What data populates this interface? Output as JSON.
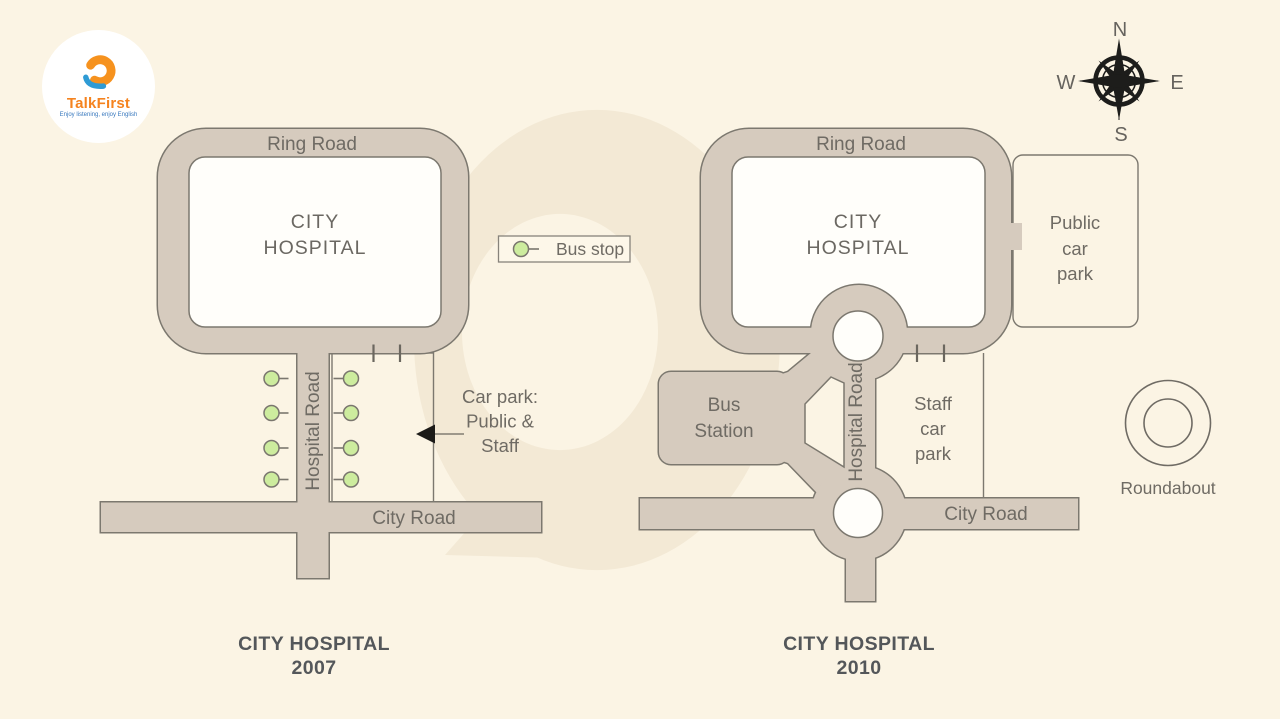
{
  "logo": {
    "brand": "TalkFirst",
    "tagline": "Enjoy listening, enjoy English"
  },
  "compass": {
    "north": "N",
    "east": "E",
    "south": "S",
    "west": "W"
  },
  "legend": {
    "bus_stop_label": "Bus stop",
    "roundabout_label": "Roundabout"
  },
  "map_2007": {
    "title": [
      "CITY HOSPITAL",
      "2007"
    ],
    "ring_road_label": "Ring Road",
    "hospital_label": [
      "CITY",
      "HOSPITAL"
    ],
    "hospital_road_label": "Hospital Road",
    "city_road_label": "City Road",
    "car_park_note": [
      "Car park:",
      "Public &",
      "Staff"
    ]
  },
  "map_2010": {
    "title": [
      "CITY HOSPITAL",
      "2010"
    ],
    "ring_road_label": "Ring Road",
    "hospital_label": [
      "CITY",
      "HOSPITAL"
    ],
    "hospital_road_label": "Hospital Road",
    "city_road_label": "City Road",
    "bus_station_label": [
      "Bus",
      "Station"
    ],
    "staff_car_park_label": [
      "Staff",
      "car",
      "park"
    ],
    "public_car_park_label": [
      "Public",
      "car",
      "park"
    ]
  },
  "colors": {
    "background": "#FBF4E4",
    "watermark": "#F3E9D5",
    "road_fill": "#D6CBBE",
    "road_outline": "#7C786F",
    "bus_stop_green": "#CDEC9E",
    "text": "#6F6B64",
    "title_text": "#54575A"
  }
}
